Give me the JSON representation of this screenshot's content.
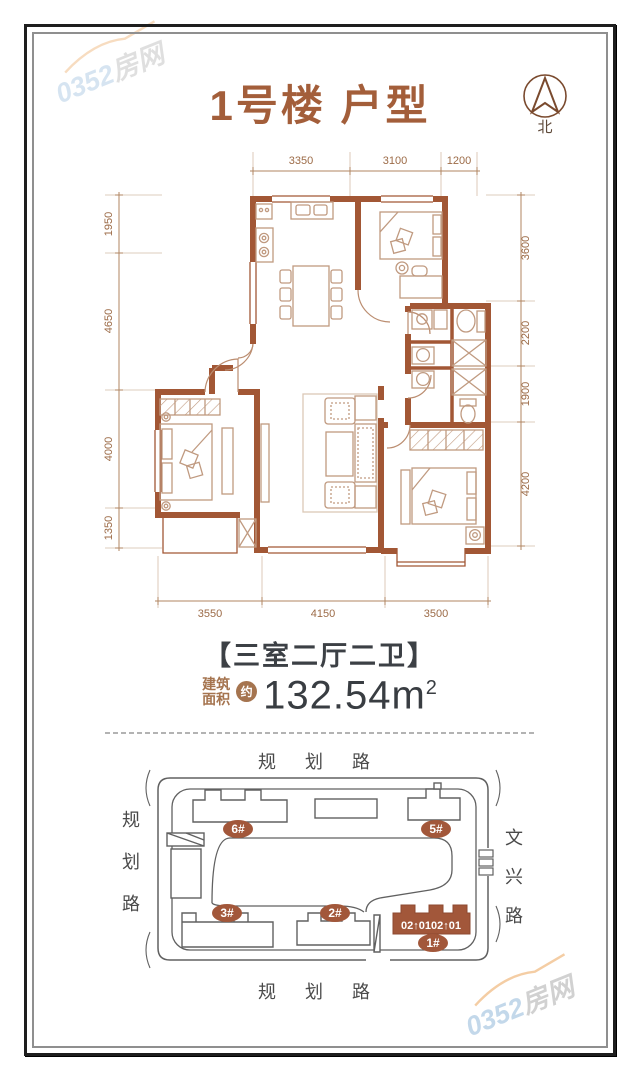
{
  "watermark": {
    "brand_number": "0352",
    "brand_suffix": "房网"
  },
  "header": {
    "title": "1号楼 户型"
  },
  "compass": {
    "label": "北"
  },
  "floorplan": {
    "dims_top": [
      "3350",
      "3100",
      "1200"
    ],
    "dims_left": [
      "1950",
      "4650",
      "4000",
      "1350"
    ],
    "dims_right": [
      "3600",
      "2200",
      "1900",
      "4200"
    ],
    "dims_bottom": [
      "3550",
      "4150",
      "3500"
    ]
  },
  "unit": {
    "layout_tag": "【三室二厅二卫】",
    "area_label_line1": "建筑",
    "area_label_line2": "面积",
    "area_approx": "约",
    "area_value": "132.54m",
    "area_superscript": "2"
  },
  "siteplan": {
    "road_top": "规 划 路",
    "road_bottom": "规 划 路",
    "road_left_chars": [
      "规",
      "划",
      "路"
    ],
    "road_right_chars": [
      "文",
      "兴",
      "路"
    ],
    "building_labels": {
      "b6": "6#",
      "b5": "5#",
      "b3": "3#",
      "b2": "2#",
      "b1": "1#"
    },
    "unit_numbers": "02↑0102↑01"
  },
  "colors": {
    "wall_brown": "#a25735",
    "accent_brown": "#a35e3a",
    "text_dark": "#3c4045",
    "site_line": "#606060",
    "watermark_blue": "#b5cfe6",
    "watermark_orange": "#f2c18e"
  }
}
